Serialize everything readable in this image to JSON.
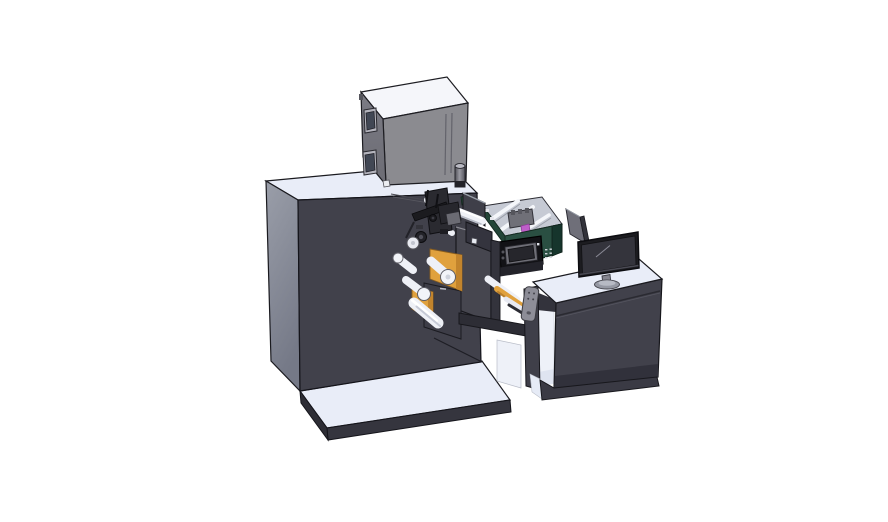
{
  "scene": {
    "title": "3D CAD assembly render of a label printing machine with operator desk",
    "background": "#ffffff",
    "parts": [
      "machine-base-plate",
      "main-cabinet",
      "top-enclosure-box",
      "exhaust-cylinder",
      "print-head-mechanism",
      "unwind-rollers",
      "label-web-orange",
      "print-module",
      "module-control-panel",
      "ink-carriage",
      "magenta-cartridge",
      "support-beam",
      "handle-bracket",
      "operator-desk",
      "desk-base-plate",
      "lcd-monitor",
      "monitor-stand",
      "secondary-display-panel"
    ]
  },
  "palette": {
    "surface_light": "#e9edf8",
    "surface_light_dim": "#dde3f1",
    "cabinet_front": "#41414b",
    "cabinet_side_top": "#989cab",
    "cabinet_side_bottom": "#74788a",
    "box_top": "#f5f6fa",
    "box_front": "#8b8b90",
    "box_side": "#74747d",
    "window_frame": "#b4b4bd",
    "window_glass": "#414754",
    "module_green": "#2a4f42",
    "module_green_dark": "#16352c",
    "interior_gray": "#c6cad4",
    "accent_orange": "#e0a13d",
    "accent_orange_dark": "#c2842c",
    "roller_white": "#eff1f7",
    "magenta": "#bf5ec9",
    "panel_black": "#121216",
    "screen_dark": "#26262c",
    "monitor_bezel": "#1c1c20",
    "monitor_screen": "#34343c",
    "metal_gray": "#8d8d97",
    "beam_dark": "#2d2d35",
    "tower_front": "#46464f",
    "base_side": "#35353e",
    "base_side_dark": "#2d2d35",
    "outline": "#1a1a1f"
  }
}
